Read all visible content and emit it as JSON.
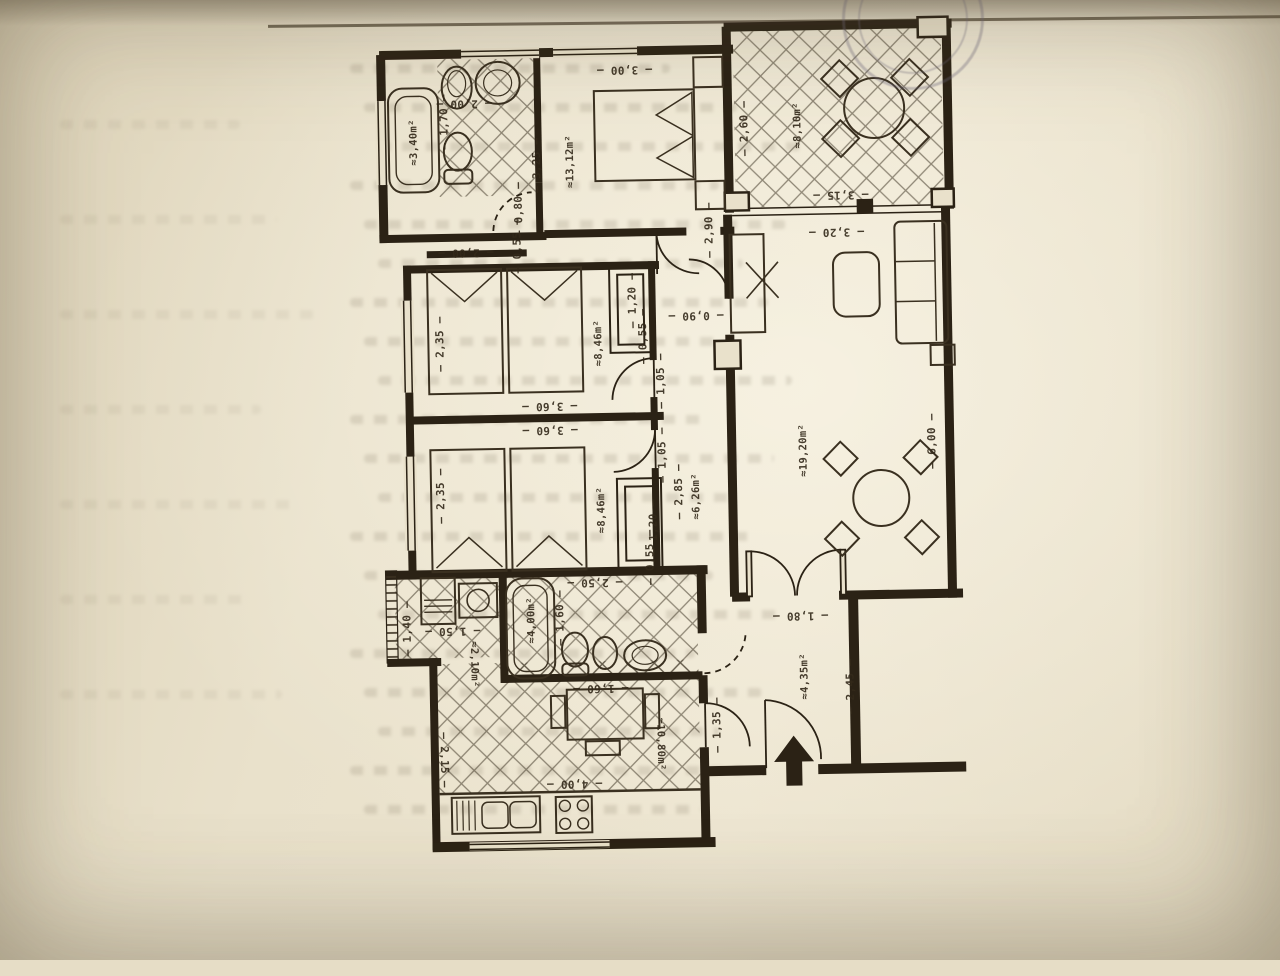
{
  "palette": {
    "paper": "#e9e1cb",
    "ink": "#2b2215",
    "wall": "#2b2215",
    "tile_line": "#3e3424",
    "label": "#33291a"
  },
  "plan": {
    "labels": [
      {
        "text": "3,00",
        "x": 631,
        "y": 69,
        "rot": 180,
        "kind": "dim"
      },
      {
        "text": "2,00",
        "x": 470,
        "y": 100,
        "rot": 180,
        "kind": "dim"
      },
      {
        "text": "1,70",
        "x": 450,
        "y": 118,
        "rot": -90,
        "kind": "dim"
      },
      {
        "text": "3,25",
        "x": 542,
        "y": 163,
        "rot": -90,
        "kind": "dim"
      },
      {
        "text": "0,80",
        "x": 523,
        "y": 207,
        "rot": -90,
        "kind": "dim"
      },
      {
        "text": "0,55",
        "x": 521,
        "y": 243,
        "rot": -90,
        "kind": "dim"
      },
      {
        "text": "2,00",
        "x": 469,
        "y": 249,
        "rot": 180,
        "kind": "dim"
      },
      {
        "text": "2,90",
        "x": 713,
        "y": 231,
        "rot": -90,
        "kind": "dim"
      },
      {
        "text": "2,60",
        "x": 750,
        "y": 130,
        "rot": -90,
        "kind": "dim"
      },
      {
        "text": "3,15",
        "x": 845,
        "y": 198,
        "rot": 180,
        "kind": "dim"
      },
      {
        "text": "3,20",
        "x": 840,
        "y": 235,
        "rot": 180,
        "kind": "dim"
      },
      {
        "text": "2,35",
        "x": 442,
        "y": 340,
        "rot": -90,
        "kind": "dim"
      },
      {
        "text": "1,20",
        "x": 635,
        "y": 300,
        "rot": -90,
        "kind": "dim"
      },
      {
        "text": "0,55",
        "x": 645,
        "y": 336,
        "rot": -90,
        "kind": "dim"
      },
      {
        "text": "0,90",
        "x": 698,
        "y": 316,
        "rot": 180,
        "kind": "dim"
      },
      {
        "text": "1,05",
        "x": 662,
        "y": 381,
        "rot": -90,
        "kind": "dim"
      },
      {
        "text": "3,60",
        "x": 550,
        "y": 404,
        "rot": 180,
        "kind": "dim"
      },
      {
        "text": "3,60",
        "x": 550,
        "y": 428,
        "rot": 180,
        "kind": "dim"
      },
      {
        "text": "2,35",
        "x": 440,
        "y": 492,
        "rot": -90,
        "kind": "dim"
      },
      {
        "text": "1,05",
        "x": 662,
        "y": 455,
        "rot": -90,
        "kind": "dim"
      },
      {
        "text": "2,85",
        "x": 678,
        "y": 492,
        "rot": -90,
        "kind": "dim"
      },
      {
        "text": "1,20",
        "x": 652,
        "y": 527,
        "rot": -90,
        "kind": "dim"
      },
      {
        "text": "0,55",
        "x": 648,
        "y": 557,
        "rot": -90,
        "kind": "dim"
      },
      {
        "text": "2,50",
        "x": 592,
        "y": 581,
        "rot": 180,
        "kind": "dim"
      },
      {
        "text": "6,00",
        "x": 932,
        "y": 446,
        "rot": -90,
        "kind": "dim"
      },
      {
        "text": "1,60",
        "x": 557,
        "y": 616,
        "rot": -90,
        "kind": "dim"
      },
      {
        "text": "1,40",
        "x": 404,
        "y": 624,
        "rot": -90,
        "kind": "dim"
      },
      {
        "text": "1,50",
        "x": 449,
        "y": 627,
        "rot": 180,
        "kind": "dim"
      },
      {
        "text": "1,60",
        "x": 596,
        "y": 687,
        "rot": 180,
        "kind": "dim"
      },
      {
        "text": "4,00",
        "x": 568,
        "y": 782,
        "rot": 180,
        "kind": "dim"
      },
      {
        "text": "2,15",
        "x": 438,
        "y": 756,
        "rot": 90,
        "kind": "dim"
      },
      {
        "text": "1,35",
        "x": 712,
        "y": 726,
        "rot": -90,
        "kind": "dim"
      },
      {
        "text": "1,80",
        "x": 797,
        "y": 618,
        "rot": 180,
        "kind": "dim"
      },
      {
        "text": "2,45",
        "x": 846,
        "y": 690,
        "rot": -90,
        "kind": "dim"
      },
      {
        "text": "≈3,40m²",
        "x": 419,
        "y": 138,
        "rot": -90,
        "kind": "area"
      },
      {
        "text": "≈13,12m²",
        "x": 575,
        "y": 160,
        "rot": -90,
        "kind": "area"
      },
      {
        "text": "≈8,10m²",
        "x": 803,
        "y": 128,
        "rot": -90,
        "kind": "area"
      },
      {
        "text": "≈8,46m²",
        "x": 600,
        "y": 342,
        "rot": -90,
        "kind": "area"
      },
      {
        "text": "≈8,46m²",
        "x": 600,
        "y": 509,
        "rot": -90,
        "kind": "area"
      },
      {
        "text": "≈6,26m²",
        "x": 695,
        "y": 497,
        "rot": -90,
        "kind": "area"
      },
      {
        "text": "≈19,20m²",
        "x": 803,
        "y": 453,
        "rot": -90,
        "kind": "area"
      },
      {
        "text": "≈4,00m²",
        "x": 528,
        "y": 618,
        "rot": -90,
        "kind": "area"
      },
      {
        "text": "≈2,10m²",
        "x": 470,
        "y": 661,
        "rot": 90,
        "kind": "area"
      },
      {
        "text": "≈10,80m²",
        "x": 655,
        "y": 744,
        "rot": 90,
        "kind": "area"
      },
      {
        "text": "≈4,35m²",
        "x": 800,
        "y": 679,
        "rot": -90,
        "kind": "area"
      }
    ]
  }
}
